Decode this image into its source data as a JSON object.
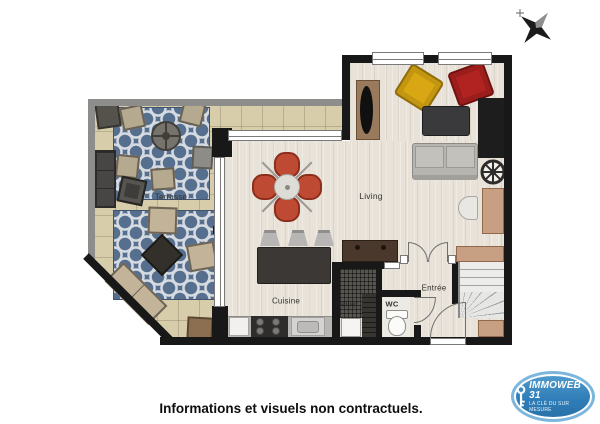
{
  "compass": {
    "name": "north-arrow"
  },
  "rooms": {
    "terrasse": {
      "label": "Terrasse"
    },
    "living": {
      "label": "Living"
    },
    "cuisine": {
      "label": "Cuisine"
    },
    "cellier": {
      "label": "Cellier"
    },
    "wc": {
      "label": "WC"
    },
    "entree": {
      "label": "Entrée"
    }
  },
  "logo": {
    "brand": "IMMOWEB 31",
    "tagline": "LA CLÉ DU SUR MESURE"
  },
  "footer": {
    "disclaimer": "Informations et visuels non contractuels."
  },
  "colors": {
    "wall": "#181818",
    "outdoor_wall": "#8d8d8b",
    "terrace_tile": "#d7cdab",
    "rug_blue": "#566f8e",
    "wood_floor": "#e8e2d8",
    "dining_set_red": "#bf4a33",
    "armchair_yellow": "#d8a713",
    "armchair_red": "#b12321",
    "kitchen_island": "#3b3835",
    "logo_blue": "#2e7cb7"
  }
}
